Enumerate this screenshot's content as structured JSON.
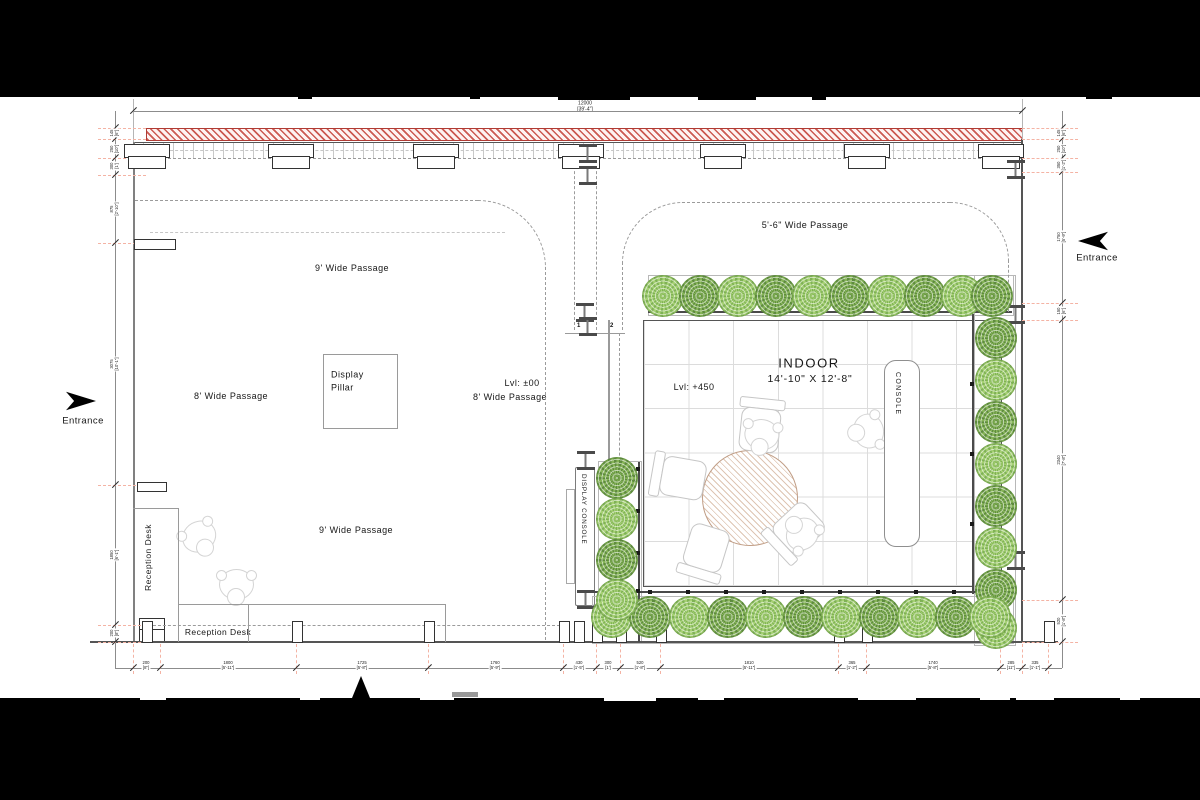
{
  "drawing": {
    "entrance_left": "Entrance",
    "entrance_right": "Entrance",
    "passage_9_top": "9' Wide Passage",
    "passage_8_left": "8' Wide Passage",
    "level_main": "Lvl: ±00",
    "passage_8_right": "8' Wide Passage",
    "passage_9_bottom": "9' Wide Passage",
    "passage_56": "5'-6\" Wide Passage",
    "display_pillar": "Display\nPillar",
    "reception_desk_side": "Reception Desk",
    "reception_desk_front": "Reception Desk",
    "indoor_title": "INDOOR",
    "indoor_size": "14'-10\" X 12'-8\"",
    "level_indoor": "Lvl: +450",
    "console": "CONSOLE",
    "display_console": "DISPLAY CONSOLE",
    "grid_1": "1",
    "grid_2": "2",
    "grid_3": "3"
  },
  "dimensions": {
    "top_total": "12000\n[39'-4\"]",
    "bottom": [
      {
        "x": 146,
        "t": "200\n[8\"]"
      },
      {
        "x": 228,
        "t": "1800\n[5'-11\"]"
      },
      {
        "x": 362,
        "t": "1725\n[5'-8\"]"
      },
      {
        "x": 495,
        "t": "1760\n[5'-9\"]"
      },
      {
        "x": 579,
        "t": "430\n[1'-5\"]"
      },
      {
        "x": 608,
        "t": "300\n[1']"
      },
      {
        "x": 640,
        "t": "520\n[1'-8\"]"
      },
      {
        "x": 749,
        "t": "1810\n[5'-11\"]"
      },
      {
        "x": 852,
        "t": "365\n[1'-2\"]"
      },
      {
        "x": 933,
        "t": "1740\n[5'-8\"]"
      },
      {
        "x": 1011,
        "t": "285\n[11\"]"
      },
      {
        "x": 1035,
        "t": "335\n[1'-1\"]"
      }
    ],
    "left": [
      {
        "y": 133,
        "t": "145\n[6\"]"
      },
      {
        "y": 149,
        "t": "250\n[10\"]"
      },
      {
        "y": 166,
        "t": "300\n[1']"
      },
      {
        "y": 209,
        "t": "875\n[2'-10\"]"
      },
      {
        "y": 364,
        "t": "3075\n[10'-1\"]"
      },
      {
        "y": 555,
        "t": "1850\n[6'-1\"]"
      },
      {
        "y": 633,
        "t": "200\n[8\"]"
      }
    ],
    "right": [
      {
        "y": 133,
        "t": "145\n[6\"]"
      },
      {
        "y": 149,
        "t": "250\n[10\"]"
      },
      {
        "y": 165,
        "t": "350\n[1'-2\"]"
      },
      {
        "y": 237,
        "t": "1750\n[5'-9\"]"
      },
      {
        "y": 311,
        "t": "150\n[6\"]"
      },
      {
        "y": 460,
        "t": "2340\n[7'-8\"]"
      },
      {
        "y": 621,
        "t": "520\n[1'-8\"]"
      }
    ]
  },
  "colors": {
    "wall_hatch": "#c5453c",
    "tree_light": "#a5d073",
    "tree_dark": "#5e8c3d",
    "dim_extension": "#f4b3a4",
    "table_hatch": "#c09d85",
    "line_dark": "#3a3a3a"
  }
}
